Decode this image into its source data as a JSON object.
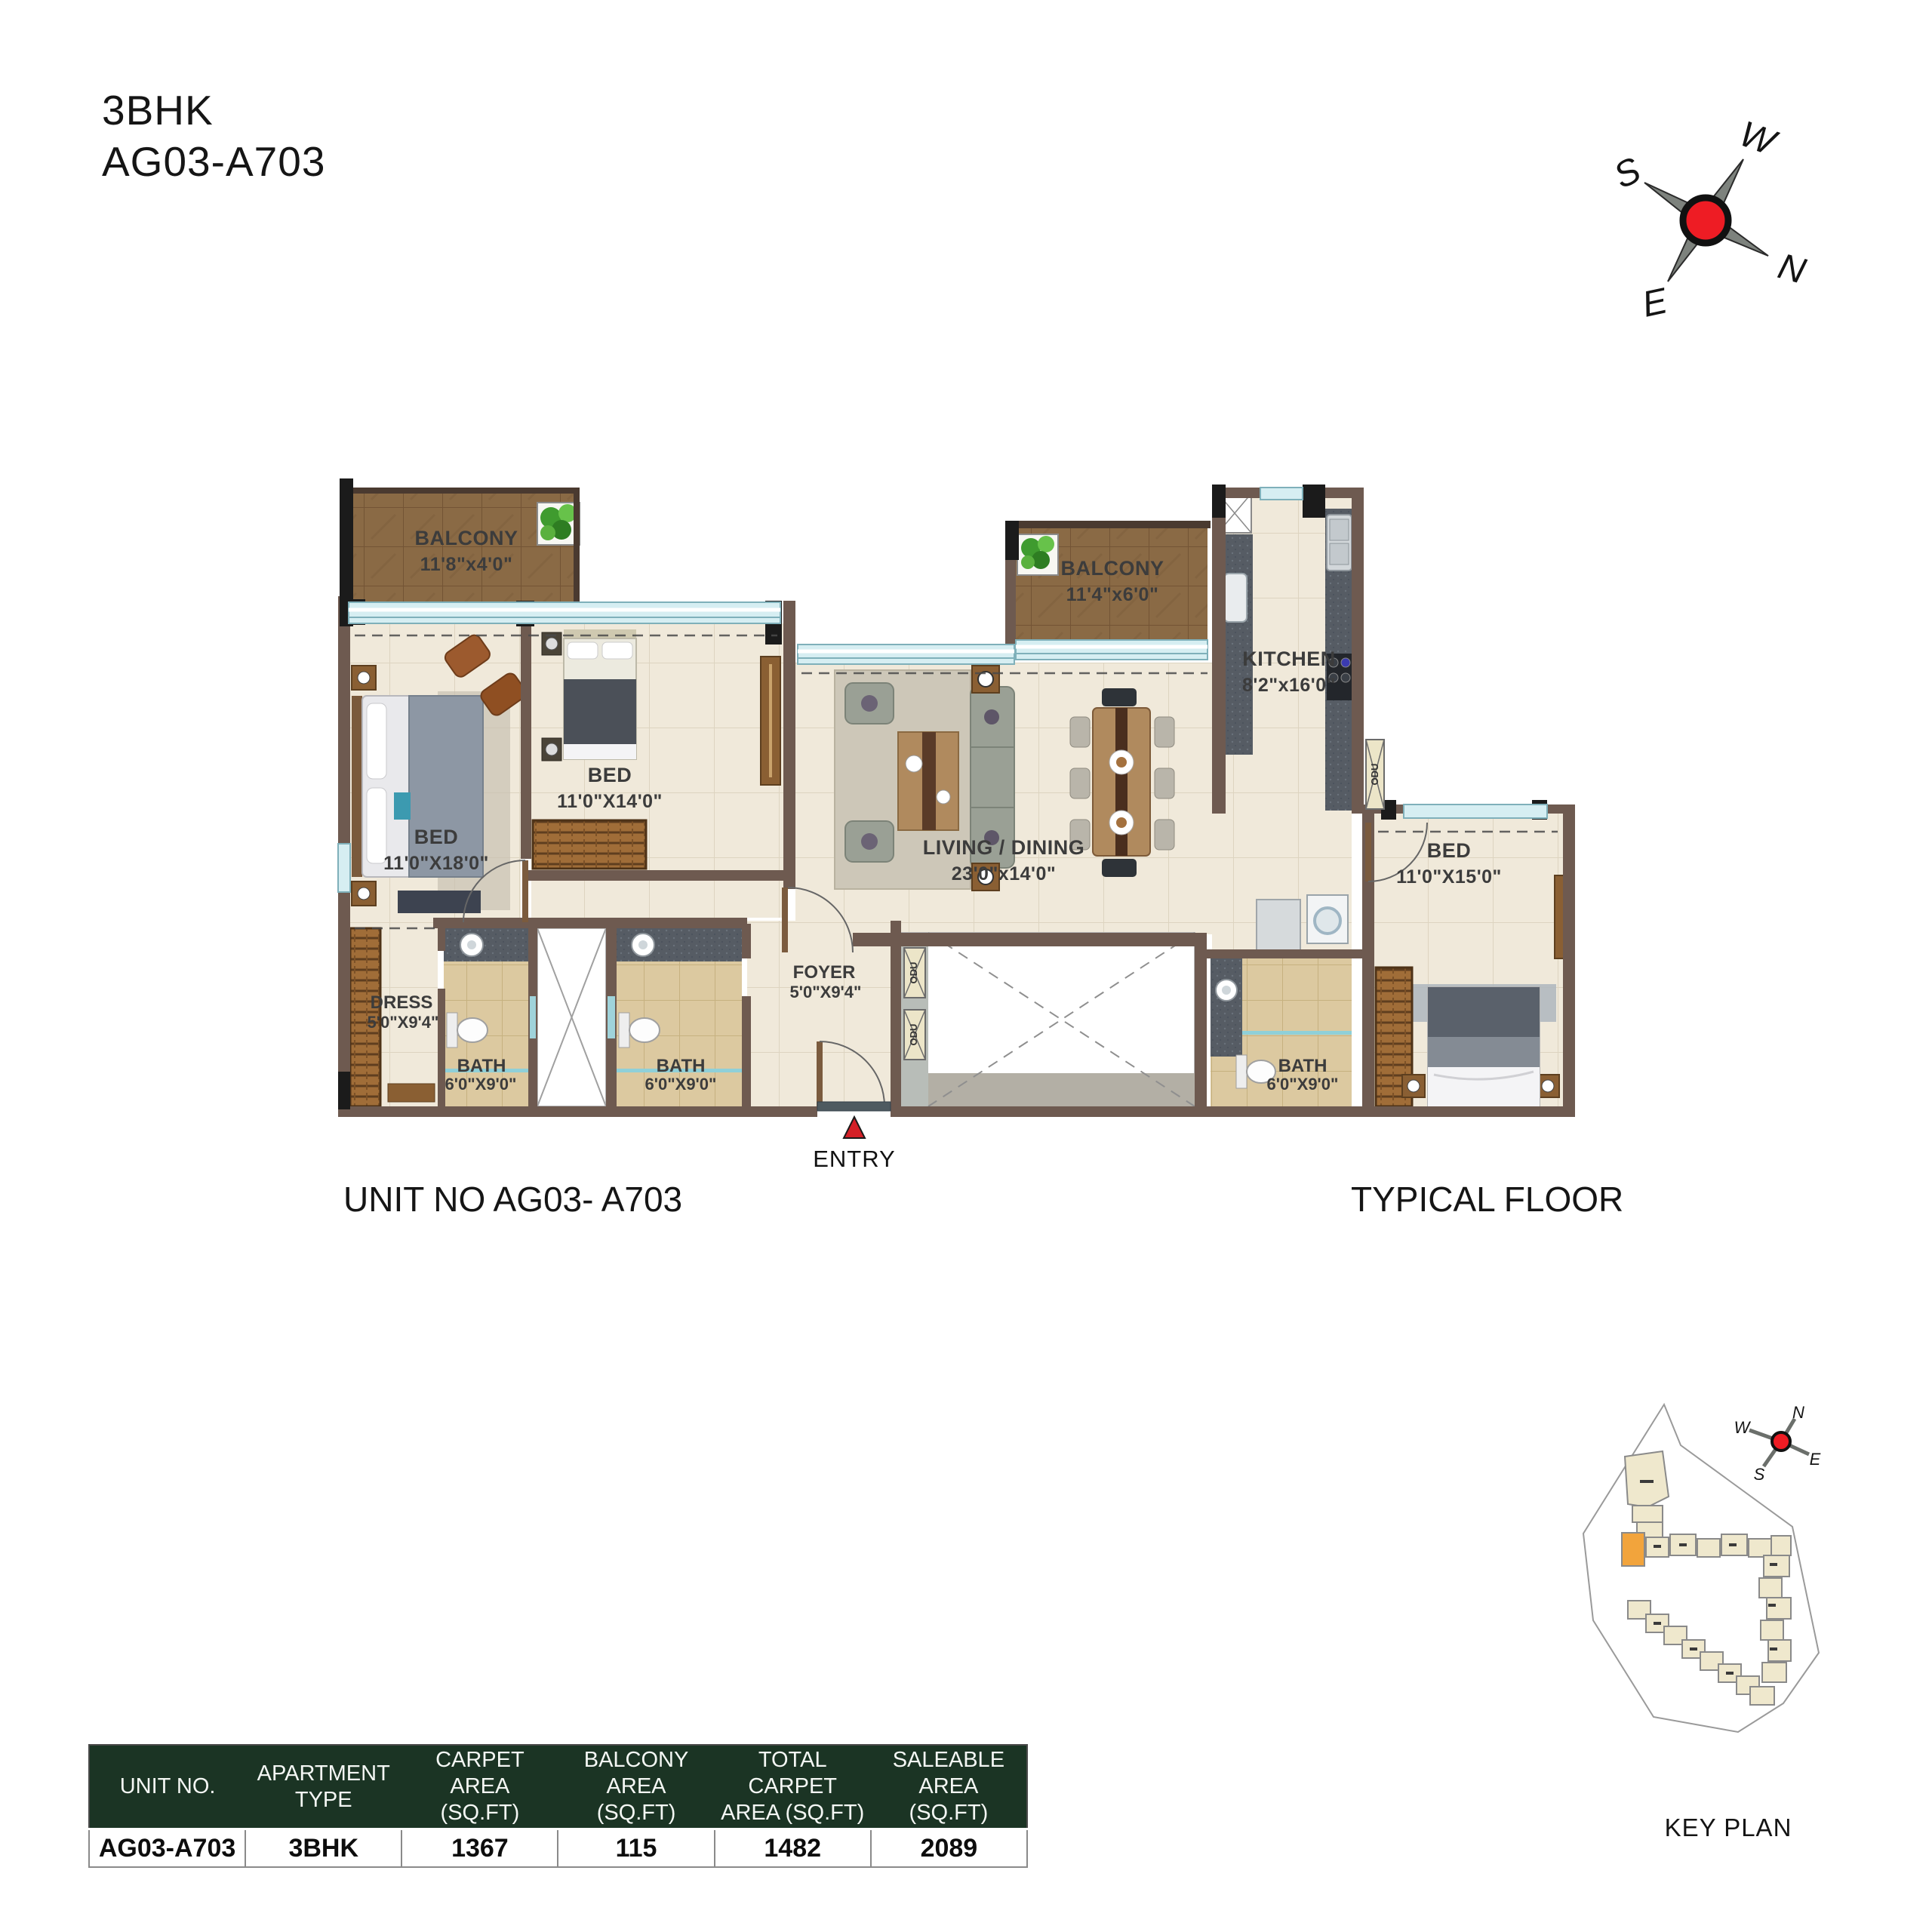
{
  "title": {
    "line1": "3BHK",
    "line2": "AG03-A703"
  },
  "compass": {
    "n": "N",
    "s": "S",
    "e": "E",
    "w": "W"
  },
  "plan": {
    "entry": "ENTRY",
    "odu": "ODU",
    "rooms": {
      "balcony1": {
        "name": "BALCONY",
        "dims": "11'8\"x4'0\""
      },
      "bed1": {
        "name": "BED",
        "dims": "11'0\"X18'0\""
      },
      "bed2": {
        "name": "BED",
        "dims": "11'0\"X14'0\""
      },
      "living": {
        "name": "LIVING / DINING",
        "dims": "23'0\"x14'0\""
      },
      "balcony2": {
        "name": "BALCONY",
        "dims": "11'4\"x6'0\""
      },
      "kitchen": {
        "name": "KITCHEN",
        "dims": "8'2\"x16'0\""
      },
      "bed3": {
        "name": "BED",
        "dims": "11'0\"X15'0\""
      },
      "dress": {
        "name": "DRESS",
        "dims": "5'0\"X9'4\""
      },
      "bath1": {
        "name": "BATH",
        "dims": "6'0\"X9'0\""
      },
      "bath2": {
        "name": "BATH",
        "dims": "6'0\"X9'0\""
      },
      "bath3": {
        "name": "BATH",
        "dims": "6'0\"X9'0\""
      },
      "foyer": {
        "name": "FOYER",
        "dims": "5'0\"X9'4\""
      }
    }
  },
  "captions": {
    "unit": "UNIT NO AG03- A703",
    "floor": "TYPICAL FLOOR",
    "keyplan": "KEY PLAN"
  },
  "table": {
    "headers": [
      [
        "UNIT NO.",
        ""
      ],
      [
        "APARTMENT",
        "TYPE"
      ],
      [
        "CARPET AREA",
        "(SQ.FT)"
      ],
      [
        "BALCONY AREA",
        "(SQ.FT)"
      ],
      [
        "TOTAL CARPET",
        "AREA (SQ.FT)"
      ],
      [
        "SALEABLE AREA",
        "(SQ.FT)"
      ]
    ],
    "row": [
      "AG03-A703",
      "3BHK",
      "1367",
      "115",
      "1482",
      "2089"
    ]
  },
  "colors": {
    "table_header_green": "#1b3424",
    "compass_red": "#ee1c24",
    "keyplan_highlight": "#f2a43c",
    "wall_brown": "#6e5a50",
    "window_aqua": "#d6eef2"
  }
}
